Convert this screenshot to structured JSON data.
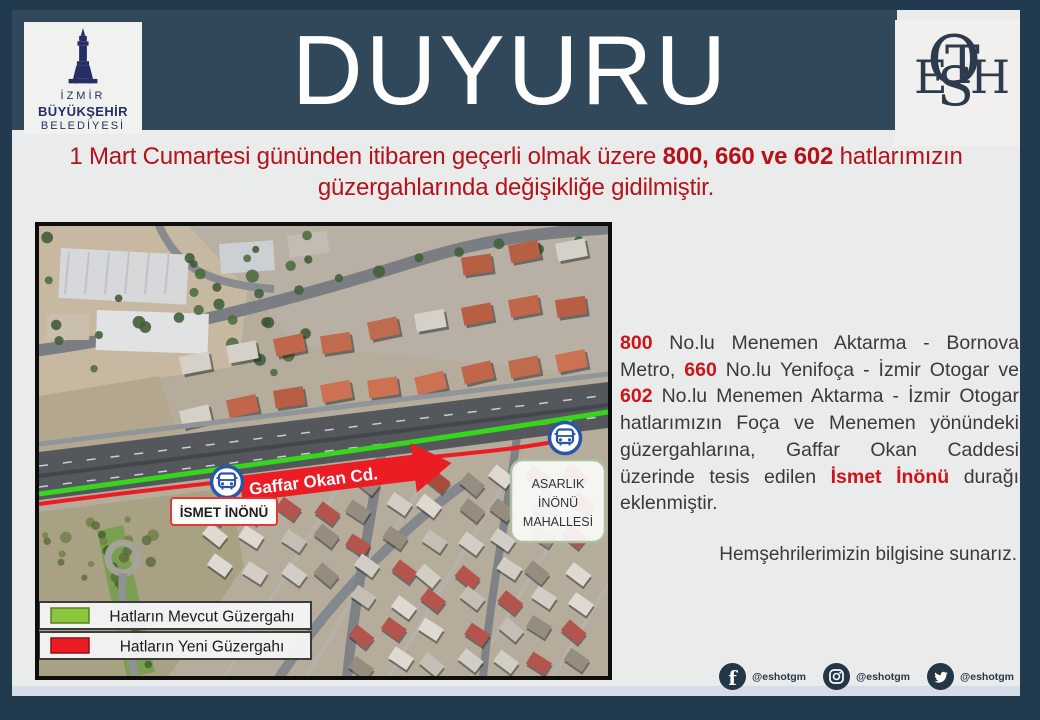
{
  "header": {
    "title": "DUYURU"
  },
  "logo_izmir": {
    "line1": "İZMİR",
    "line2": "BÜYÜKŞEHİR",
    "line3": "BELEDİYESİ"
  },
  "logo_eshot": {
    "e": "E",
    "s": "S",
    "h": "H",
    "o": "O",
    "t": "T"
  },
  "headline": {
    "line1_pre": "1 Mart Cumartesi gününden itibaren geçerli olmak üzere ",
    "line1_bold": "800, 660 ve 602",
    "line1_post": " hatlarımızın",
    "line2": "güzergahlarında değişikliğe gidilmiştir."
  },
  "map": {
    "street_arrow_label": "Gaffar Okan Cd.",
    "stop_label": "İSMET İNÖNÜ",
    "district_label_line1": "ASARLIK",
    "district_label_line2": "İNÖNÜ",
    "district_label_line3": "MAHALLESİ",
    "legend_current_label": "Hatların Mevcut Güzergahı",
    "legend_new_label": "Hatların Yeni Güzergahı",
    "colors": {
      "current_route": "#35D61C",
      "new_route": "#EC1C24",
      "legend_current_swatch": "#8CC63E",
      "bus_stop_blue": "#2B55A8"
    }
  },
  "body_text": {
    "num_800": "800",
    "seg_1": " No.lu Menemen Aktarma - Bornova Metro, ",
    "num_660": "660",
    "seg_2": " No.lu Yenifoça  - İzmir Otogar ve ",
    "num_602": "602",
    "seg_3": " No.lu Menemen Aktarma - İzmir Otogar hatlarımızın Foça ve Menemen yönündeki güzergahlarına, Gaffar Okan Caddesi üzerinde tesis edilen ",
    "highlight_stop": "İsmet İnönü",
    "seg_4": " durağı eklenmiştir.",
    "closing": "Hemşehrilerimizin bilgisine sunarız."
  },
  "social": {
    "facebook_handle": "@eshotgm",
    "instagram_handle": "@eshotgm",
    "twitter_handle": "@eshotgm"
  },
  "colors": {
    "accent_red": "#B5121A",
    "frame_navy": "#223A4E",
    "band_slate": "#31485A"
  }
}
